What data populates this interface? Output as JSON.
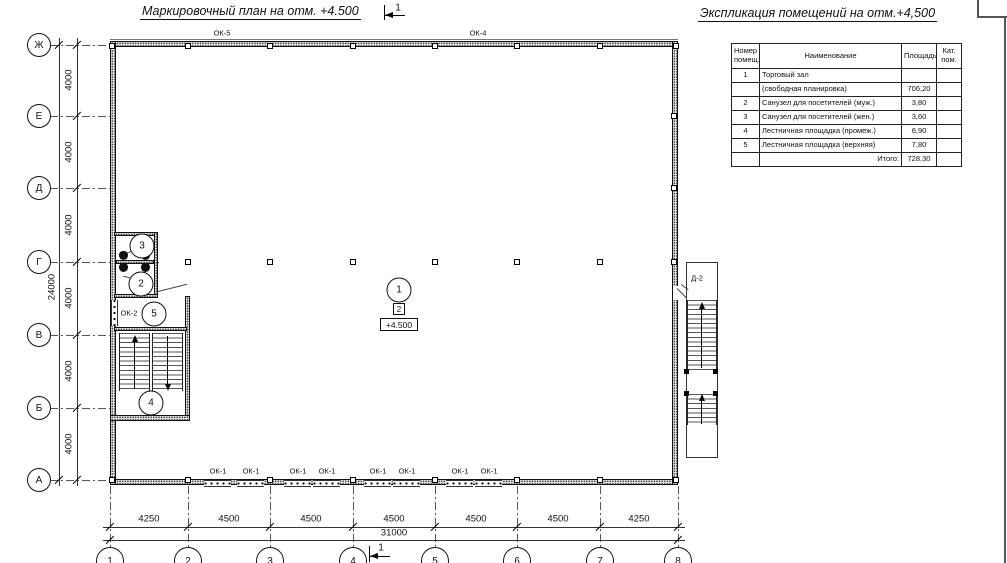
{
  "titles": {
    "plan": "Маркировочный план на отм. +4.500",
    "explication": "Экспликация помещений на отм.+4,500"
  },
  "section_marks": {
    "top": "1",
    "bottom": "1"
  },
  "grid": {
    "rows": [
      {
        "label": "Ж"
      },
      {
        "label": "Е"
      },
      {
        "label": "Д"
      },
      {
        "label": "Г"
      },
      {
        "label": "В"
      },
      {
        "label": "Б"
      },
      {
        "label": "А"
      }
    ],
    "row_spacings": [
      "4000",
      "4000",
      "4000",
      "4000",
      "4000",
      "4000"
    ],
    "rows_total": "24000",
    "cols": [
      {
        "label": "1"
      },
      {
        "label": "2"
      },
      {
        "label": "3"
      },
      {
        "label": "4"
      },
      {
        "label": "5"
      },
      {
        "label": "6"
      },
      {
        "label": "7"
      },
      {
        "label": "8"
      }
    ],
    "col_spacings": [
      "4250",
      "4500",
      "4500",
      "4500",
      "4500",
      "4500",
      "4250"
    ],
    "cols_total": "31000"
  },
  "openings": {
    "ok5": "ОК-5",
    "ok4": "ОК-4",
    "ok2": "ОК-2",
    "door": "Д-2",
    "ok1": [
      "ОК-1",
      "ОК-1",
      "ОК-1",
      "ОК-1",
      "ОК-1",
      "ОК-1",
      "ОК-1",
      "ОК-1"
    ]
  },
  "markers": {
    "room1": "1",
    "room2": "2",
    "room3": "3",
    "room4": "4",
    "room5": "5",
    "detail": "2",
    "elevation": "+4.500"
  },
  "table": {
    "headers": [
      "Номер помещ.",
      "Наименование",
      "Площадь",
      "Кат. пом."
    ],
    "rows": [
      [
        "1",
        "Торговый зал",
        "",
        ""
      ],
      [
        "",
        "(свободная планировка)",
        "706,20",
        ""
      ],
      [
        "2",
        "Санузел для посетителей (муж.)",
        "3,80",
        ""
      ],
      [
        "3",
        "Санузел для посетителей (жен.)",
        "3,60",
        ""
      ],
      [
        "4",
        "Лестничная площадка (промеж.)",
        "6,90",
        ""
      ],
      [
        "5",
        "Лестничная площадка (верхняя)",
        "7,80",
        ""
      ],
      [
        "",
        "Итого:",
        "728,30",
        ""
      ]
    ]
  }
}
